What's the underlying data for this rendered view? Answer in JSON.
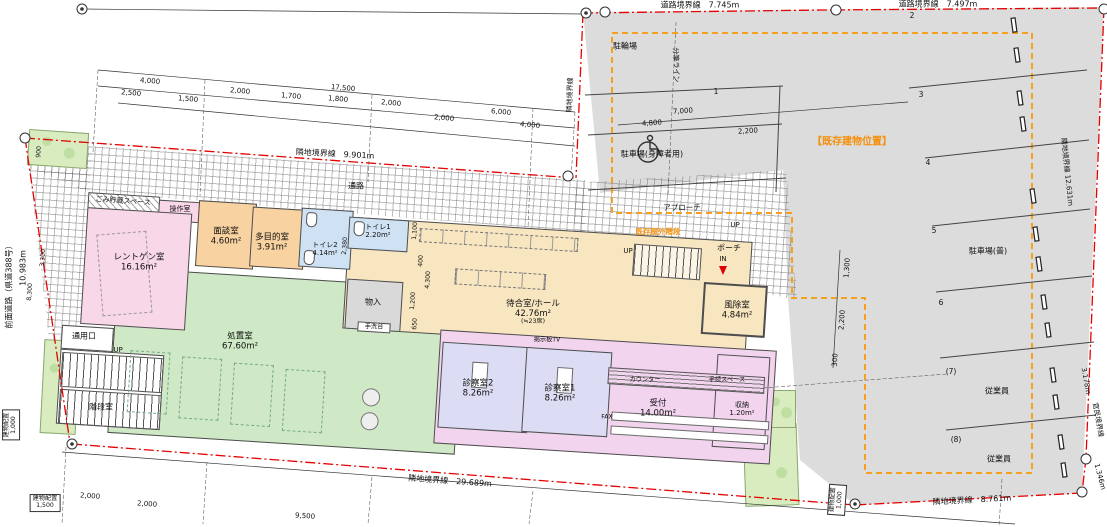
{
  "colors": {
    "boundary_red": "#e60000",
    "existing_orange": "#f5900a",
    "parking_gray": "#dcdcdc",
    "room_pink": "#f8d7e8",
    "room_peach": "#f8d2a0",
    "room_blue": "#cfe2f4",
    "room_green": "#cfe8c6",
    "room_cream": "#f7e6c0",
    "room_lavender": "#dcdcf4",
    "room_purple": "#f3d4ef",
    "planter_green": "#d9ecc0"
  },
  "rooms": {
    "garbage": {
      "name": "ごみ貯蔵スペース"
    },
    "control": {
      "name": "操作室"
    },
    "xray": {
      "name": "レントゲン室",
      "area": "16.16m²"
    },
    "interview": {
      "name": "面談室",
      "area": "4.60m²"
    },
    "multi": {
      "name": "多目的室",
      "area": "3.91m²"
    },
    "toilet2": {
      "name": "トイレ2",
      "area": "4.14m²"
    },
    "toilet1": {
      "name": "トイレ1",
      "area": "2.20m²"
    },
    "treatment": {
      "name": "処置室",
      "area": "67.60m²"
    },
    "closet": {
      "name": "物入"
    },
    "wash": {
      "name": "手洗台"
    },
    "waiting": {
      "name": "待合室/ホール",
      "area": "42.76m²",
      "seats": "(≒23席)"
    },
    "windbreak": {
      "name": "風除室",
      "area": "4.84m²"
    },
    "exam2": {
      "name": "診察室2",
      "area": "8.26m²"
    },
    "exam1": {
      "name": "診察室1",
      "area": "8.26m²"
    },
    "reception": {
      "name": "受付",
      "area": "14.00m²"
    },
    "storage": {
      "name": "収納",
      "area": "1.20m²"
    },
    "stairwell": {
      "name": "階段室"
    },
    "service_entrance": {
      "name": "通用口"
    }
  },
  "site": {
    "passage": "通路",
    "approach": "アプローチ",
    "porch": "ポーチ",
    "existing_stairs": "既存屋外階段",
    "up": "UP",
    "dn": "DN",
    "in_label": "IN",
    "counter": "カウンター",
    "procedure_space": "手続スペース",
    "fax": "FAX",
    "tv_board": "掲示板TV"
  },
  "parking": {
    "bicycle": "駐輪場",
    "accessible": "駐車場(身障者用)",
    "regular": "駐車場(普)",
    "existing_building": "【既存建物位置】",
    "employee": "従業員",
    "stalls": [
      "1",
      "2",
      "3",
      "4",
      "5",
      "6",
      "(7)",
      "(8)"
    ]
  },
  "boundaries": {
    "road_top1": "道路境界線　7.745m",
    "road_top2": "道路境界線　7.497m",
    "adjacent_top": "隣地境界線　9.901m",
    "adjacent_bottom": "隣地境界線　29.689m",
    "adjacent_bottom_right": "隣地境界線　8.761m",
    "right_upper": "隣地境界線 12.631m",
    "right_public": "官民境界線",
    "right_3178": "3.178m",
    "right_1346": "1.346m",
    "front_road": "前面道路（県道388号）",
    "front_length": "10.983m",
    "mid_vertical": "隣地境界線",
    "lot_split": "分筆ライン"
  },
  "dims": {
    "v17500": "17,500",
    "v4000": "4,000",
    "v2500": "2,500",
    "v2000": "2,000",
    "v1700": "1,700",
    "v1800": "1,800",
    "v1500": "1,500",
    "v6000": "6,000",
    "v7000": "7,000",
    "v4800": "4,800",
    "v2200": "2,200",
    "v1300": "1,300",
    "v300": "300",
    "v9500": "9,500",
    "v1100": "1,100",
    "v400": "400",
    "v4300": "4,300",
    "v1200": "1,200",
    "v650": "650",
    "v2380": "2,380",
    "v900": "900",
    "v3300": "3,300",
    "v8300": "8,300",
    "v1000": "1,000",
    "placement": "建物配置"
  }
}
